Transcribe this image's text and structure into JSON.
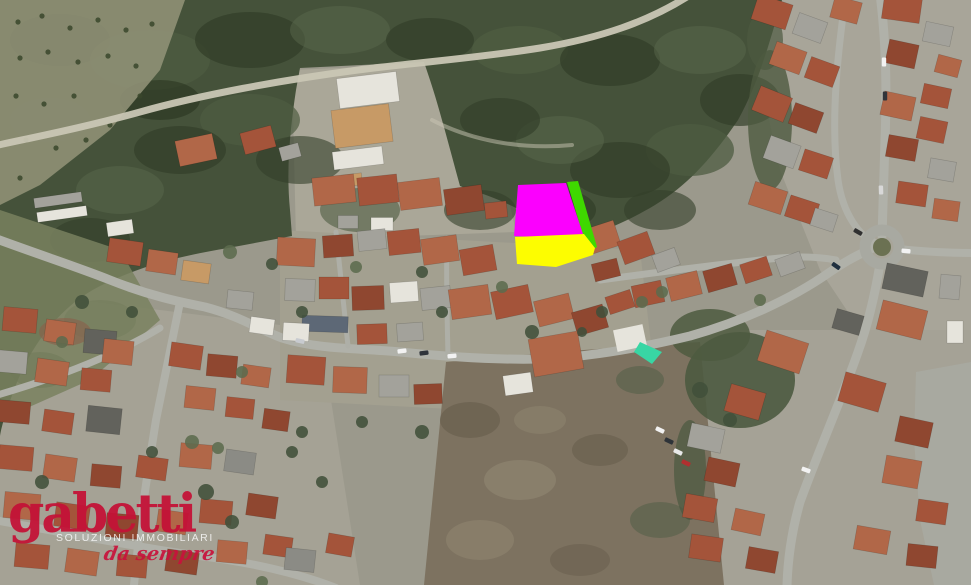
{
  "map": {
    "type": "satellite-aerial",
    "description": "Aerial satellite view of a hillside town with wooded slopes, a winding main street, a roundabout and a highlighted building parcel",
    "parcel_overlay": {
      "primary_color": "#fb00fe",
      "secondary_color": "#fdfd00",
      "edge_color": "#3fd800"
    }
  },
  "watermark": {
    "brand": "gabetti",
    "tagline": "SOLUZIONI IMMOBILIARI",
    "script": "da sempre",
    "brand_color": "#c41237"
  }
}
